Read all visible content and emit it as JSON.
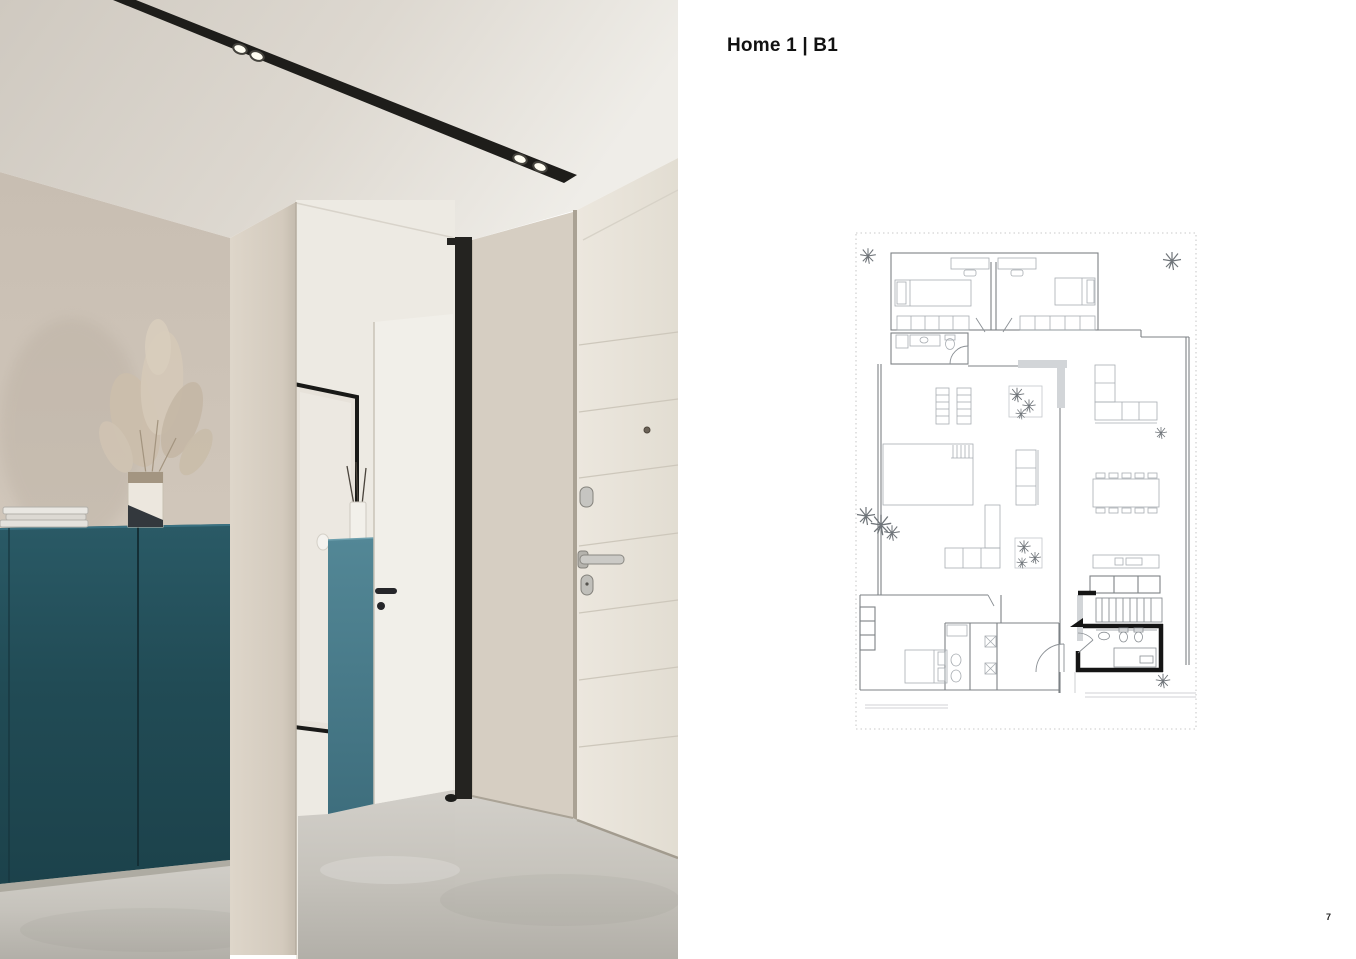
{
  "page": {
    "title": "Home 1 | B1",
    "page_number": "7",
    "background": "#ffffff"
  },
  "photo": {
    "alt": "Entry hallway render: dark teal sideboard with magazines and pampas-grass vase, beige walls, black recessed ceiling track lights, black-framed mirror, small teal cabinet with reed diffuser, white interior door, black pivot frame and white front entrance door on concrete floor",
    "colors": {
      "teal_cabinet_dark": "#1f4850",
      "teal_cabinet_light": "#4f8292",
      "wall_beige": "#cdc3b7",
      "ceiling_beige": "#d8d2c9",
      "floor_gray": "#c6c3bc",
      "track_black": "#1e1d1a",
      "front_door_white": "#e9e4db"
    }
  },
  "floor_plan": {
    "alt": "Floor plan B1: two bedrooms with wardrobes and bathroom, open living-dining-kitchen with terrace windows, master suite with ensuite and laundry, entrance with staircase and black-walled bathroom, plants on terrace",
    "line_color": "#7d8286",
    "furniture_color": "#a8adb2",
    "accent_black": "#151515"
  }
}
